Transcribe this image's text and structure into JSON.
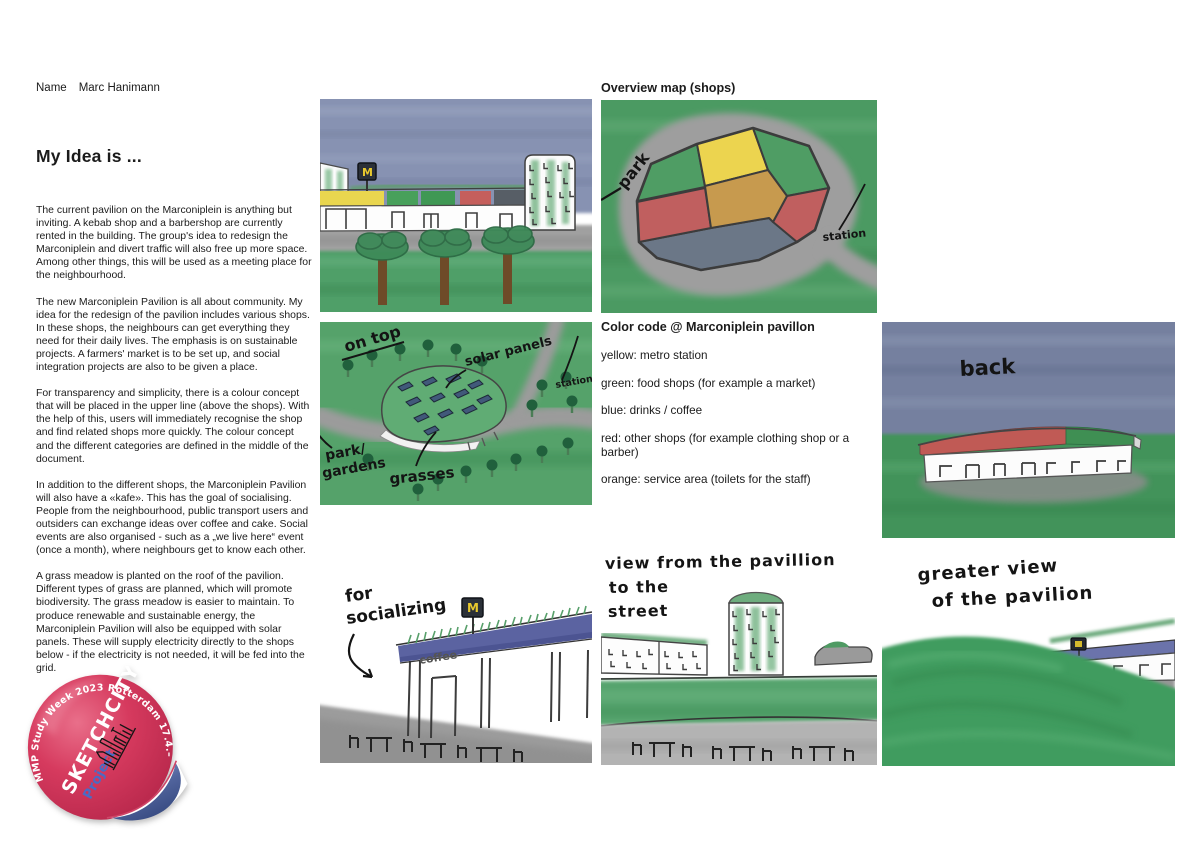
{
  "header": {
    "name_label": "Name",
    "name_value": "Marc Hanimann"
  },
  "intro": {
    "heading": "My Idea is ...",
    "paragraphs": [
      "The current pavilion on the Marconiplein is anything but inviting. A kebab shop and a barbershop are currently rented in the building. The group's idea to redesign the Marconiplein and divert traffic will also free up more space. Among other things, this will be used as a meeting place for the neighbourhood.",
      "The new Marconiplein Pavilion is all about community. My idea for the redesign of the pavilion includes various shops. In these shops, the neighbours can get everything they need for their daily lives. The emphasis is on sustainable projects. A farmers' market is to be set up, and social integration projects are also to be given a place.",
      "For transparency and simplicity, there is a colour concept that will be placed in the upper line (above the shops). With the help of this, users will immediately recognise the shop and find related shops more quickly. The colour concept and the different categories are defined in the middle of the document.",
      "In addition to the different shops, the Marconiplein Pavilion will also have a «kafe». This has the goal of socialising. People from the neighbourhood, public transport users and outsiders can exchange ideas over coffee and cake. Social events are also organised - such as a „we live here“ event (once a month), where neighbours get to know each other.",
      "A grass meadow is planted on the roof of the pavilion. Different types of grass are planned, which will promote biodiversity. The grass meadow is easier to maintain. To produce renewable and sustainable energy, the Marconiplein Pavilion will also be equipped with solar panels. These will supply electricity directly to the shops below - if the electricity is not needed, it will be fed into the grid."
    ]
  },
  "overview": {
    "heading": "Overview map (shops)"
  },
  "color_code": {
    "title": "Color code @ Marconiplein pavillon",
    "entries": [
      "yellow: metro station",
      "green: food shops (for example a market)",
      "blue: drinks / coffee",
      "red: other shops (for example clothing shop or a barber)",
      "orange: service area (toilets for the staff)"
    ]
  },
  "sketches": {
    "street_front": {
      "metro_m": "M"
    },
    "map": {
      "park": "park",
      "station": "station"
    },
    "roof": {
      "on_top": "on top",
      "solar_panels": "solar panels",
      "station": "station",
      "park": "park/",
      "gardens": "gardens",
      "grasses": "grasses"
    },
    "back": {
      "back": "back"
    },
    "socializing": {
      "for": "for",
      "socializing": "socializing",
      "coffee": "coffee",
      "metro_m": "M"
    },
    "street_view": {
      "line1": "view from the pavillion",
      "line2": "to the",
      "line3": "street"
    },
    "greater_view": {
      "line1": "greater view",
      "line2": "of the pavilion"
    }
  },
  "sticker": {
    "arc_text": "MMP Study Week 2023 Rotterdam 17.4.–21.4.2023",
    "brand": "SKETCHCITY",
    "subtitle": "Project"
  },
  "colors": {
    "strip_yellow": "#e9d64f",
    "strip_green": "#449c58",
    "strip_red": "#c55f5c",
    "strip_dark": "#575e66",
    "map_orange": "#c79a4e",
    "map_blue": "#6b7787",
    "sky_blue": "#8792b2",
    "grass_green": "#4f9f68",
    "road_grey": "#9e9e9e",
    "fascia_blue": "#5b63a1",
    "metro_yellow": "#e8c92e",
    "sticker_pink": "#d63a5e",
    "sticker_curl_blue": "#52659e",
    "project_blue": "#4a6bc4"
  }
}
